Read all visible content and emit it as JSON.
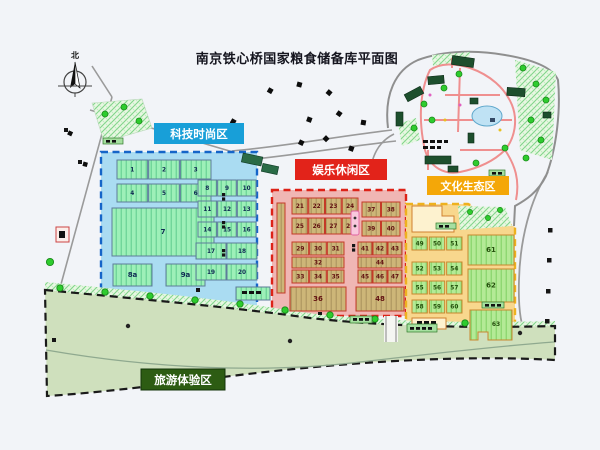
{
  "title": "南京铁心桥国家粮食储备库平面图",
  "compass": {
    "north_label": "北"
  },
  "zones": {
    "tech": {
      "label": "科技时尚区",
      "label_bg": "#189fd8",
      "fill": "#aadcf2",
      "border": "#1565c8",
      "groups": [
        [
          "1",
          "2",
          "3"
        ],
        [
          "4",
          "5",
          "6"
        ],
        [
          "7"
        ],
        [
          "8a",
          "9a"
        ],
        [
          "8",
          "9",
          "10"
        ],
        [
          "11",
          "12",
          "13"
        ],
        [
          "14",
          "15",
          "16"
        ],
        [
          "17",
          "18"
        ],
        [
          "19",
          "20"
        ]
      ]
    },
    "fun": {
      "label": "娱乐休闲区",
      "label_bg": "#e2231a",
      "fill": "#f0b6b4",
      "border": "#dd2218",
      "groups": [
        [
          "21",
          "22",
          "23",
          "24"
        ],
        [
          "25",
          "26",
          "27",
          "28"
        ],
        [
          "37",
          "38"
        ],
        [
          "39",
          "40"
        ],
        [
          "29",
          "30",
          "31"
        ],
        [
          "32"
        ],
        [
          "33",
          "34",
          "35"
        ],
        [
          "41",
          "42",
          "43"
        ],
        [
          "44"
        ],
        [
          "45",
          "46",
          "47"
        ],
        [
          "36"
        ],
        [
          "48"
        ]
      ]
    },
    "culture": {
      "label": "文化生态区",
      "label_bg": "#f4a708",
      "fill": "#f8d78d",
      "border": "#eeb11e",
      "groups": [
        [
          "49",
          "50",
          "51"
        ],
        [
          "52",
          "53",
          "54"
        ],
        [
          "55",
          "56",
          "57"
        ],
        [
          "58",
          "59",
          "60"
        ],
        [
          "61"
        ],
        [
          "62"
        ],
        [
          "63"
        ]
      ]
    },
    "tourism": {
      "label": "旅游体验区",
      "label_bg": "#2d5c13",
      "fill": "#cfe0bd",
      "border": "#1a1a1a"
    }
  }
}
